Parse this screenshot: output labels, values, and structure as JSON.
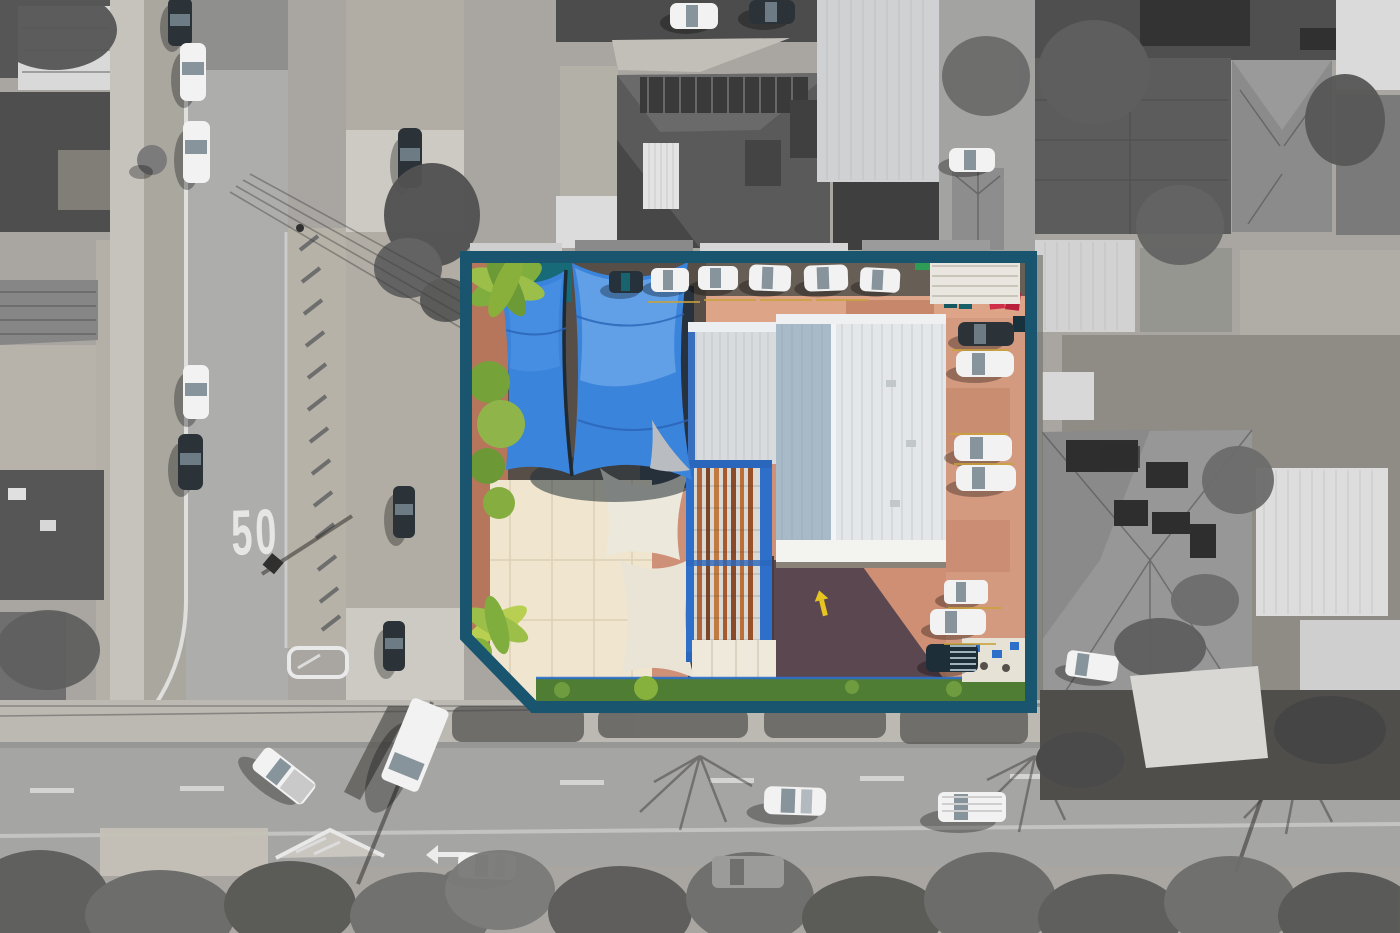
{
  "scene": {
    "type": "aerial-drone-photograph",
    "treatment": "selective colour: highlighted property parcel in full colour with teal outline, surroundings desaturated greyscale",
    "road_marking_speed_limit": "50",
    "boundary_shape": "rectangle with angled (chamfered) south-west corner"
  },
  "property": {
    "features": [
      "two large blue shade sails over yard",
      "cream warehouse roof (south-west)",
      "rusted corrugated iron roof with blue steel trim (centre)",
      "silver and white corrugated warehouse roofs",
      "terracotta paved driveways and parking",
      "row of parked cars along street frontage",
      "column of parked cars along eastern boundary",
      "red, teal and green wheelie bins",
      "green lawn strip and round shrub along southern frontage",
      "palm tree and shrubs along western boundary",
      "white shade sails near cream roof",
      "outdoor seating deck (south-east corner)",
      "yellow pavement arrow marking"
    ]
  },
  "surroundings": {
    "features": [
      "side street with 50 speed-limit road marking",
      "cars parked along side street",
      "main road along southern frontage with traffic",
      "painted traffic islands and chevron median",
      "suburban houses with tiled and corrugated roofs",
      "rooftop solar panel arrays",
      "street trees, tree canopy along main road",
      "power poles, wires and long pole shadows"
    ]
  },
  "colors": {
    "boundary_teal": "#1a5570",
    "sail_blue": "#3b84dc",
    "sail_blue_dark": "#2a63b5",
    "sail_highlight": "#6fa9ea",
    "terracotta": "#cf9078",
    "terracotta_light": "#dda488",
    "dark_paving": "#54434e",
    "asphalt_brown": "#675e55",
    "cream_roof": "#f0e6cf",
    "white_sail": "#ece8db",
    "rust_orange": "#b06438",
    "trim_blue": "#2d6fc9",
    "silver_roof": "#d8dbdd",
    "warehouse_white": "#e4e7e9",
    "warehouse_shade": "#a8bac8",
    "grass_green": "#4f7d33",
    "shrub_green": "#86b13c",
    "palm_green": "#9cbf4a",
    "pool_teal": "#176a77",
    "bin_red": "#d02f4a",
    "bin_teal": "#14575f",
    "bin_green": "#2e9c55",
    "marking_yellow": "#e6c520",
    "road_grey": "#a6a6a6",
    "concrete_grey": "#c9c6c0",
    "marking_white": "#e6e6e4"
  }
}
